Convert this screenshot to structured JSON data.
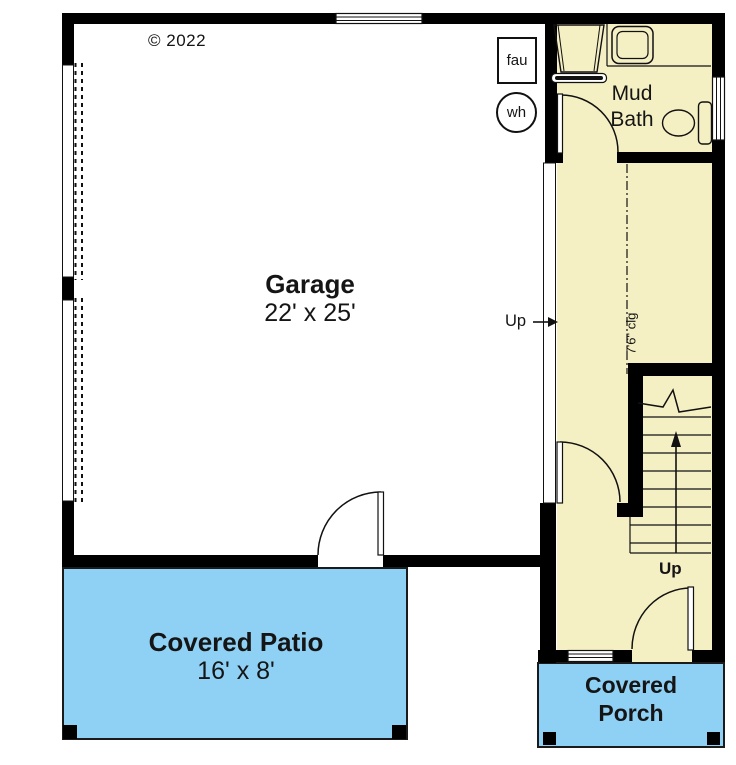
{
  "copyright": "© 2022",
  "rooms": {
    "garage": {
      "name": "Garage",
      "dims": "22' x 25'"
    },
    "mud_bath": {
      "name_line1": "Mud",
      "name_line2": "Bath"
    },
    "covered_patio": {
      "name": "Covered Patio",
      "dims": "16' x 8'"
    },
    "covered_porch": {
      "name_line1": "Covered",
      "name_line2": "Porch"
    }
  },
  "labels": {
    "furnace": "fau",
    "water_heater": "wh",
    "up_from_garage": "Up",
    "up_stairs": "Up",
    "ceiling_height": "7'6\" clg"
  },
  "colors": {
    "interior_fill": "#F5F0C4",
    "outdoor_fill": "#8FD1F5",
    "wall": "#000000",
    "line": "#111111"
  }
}
